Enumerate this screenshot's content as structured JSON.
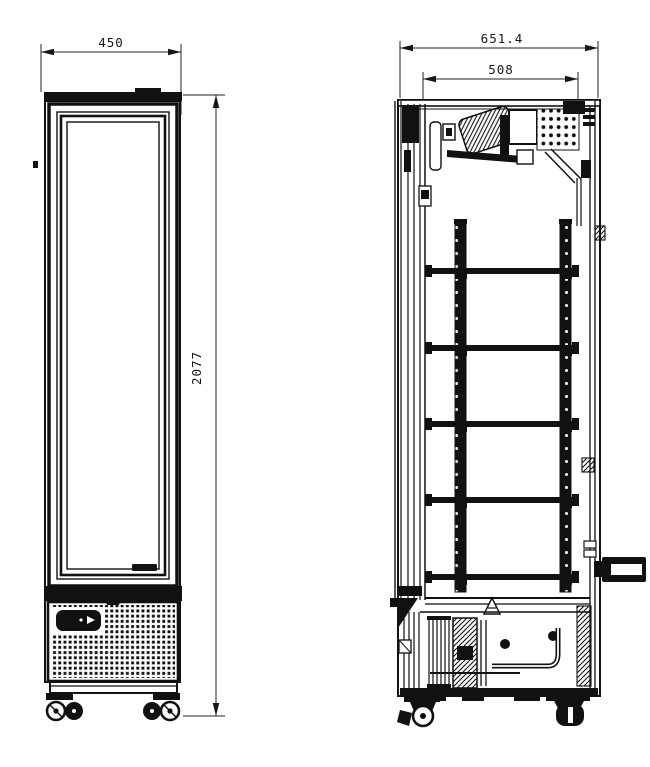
{
  "drawing": {
    "background_color": "#ffffff",
    "ink_color": "#111111",
    "dimensions": {
      "front_width": "450",
      "front_height": "2077",
      "side_depth_overall": "651.4",
      "side_depth_internal": "508"
    }
  }
}
